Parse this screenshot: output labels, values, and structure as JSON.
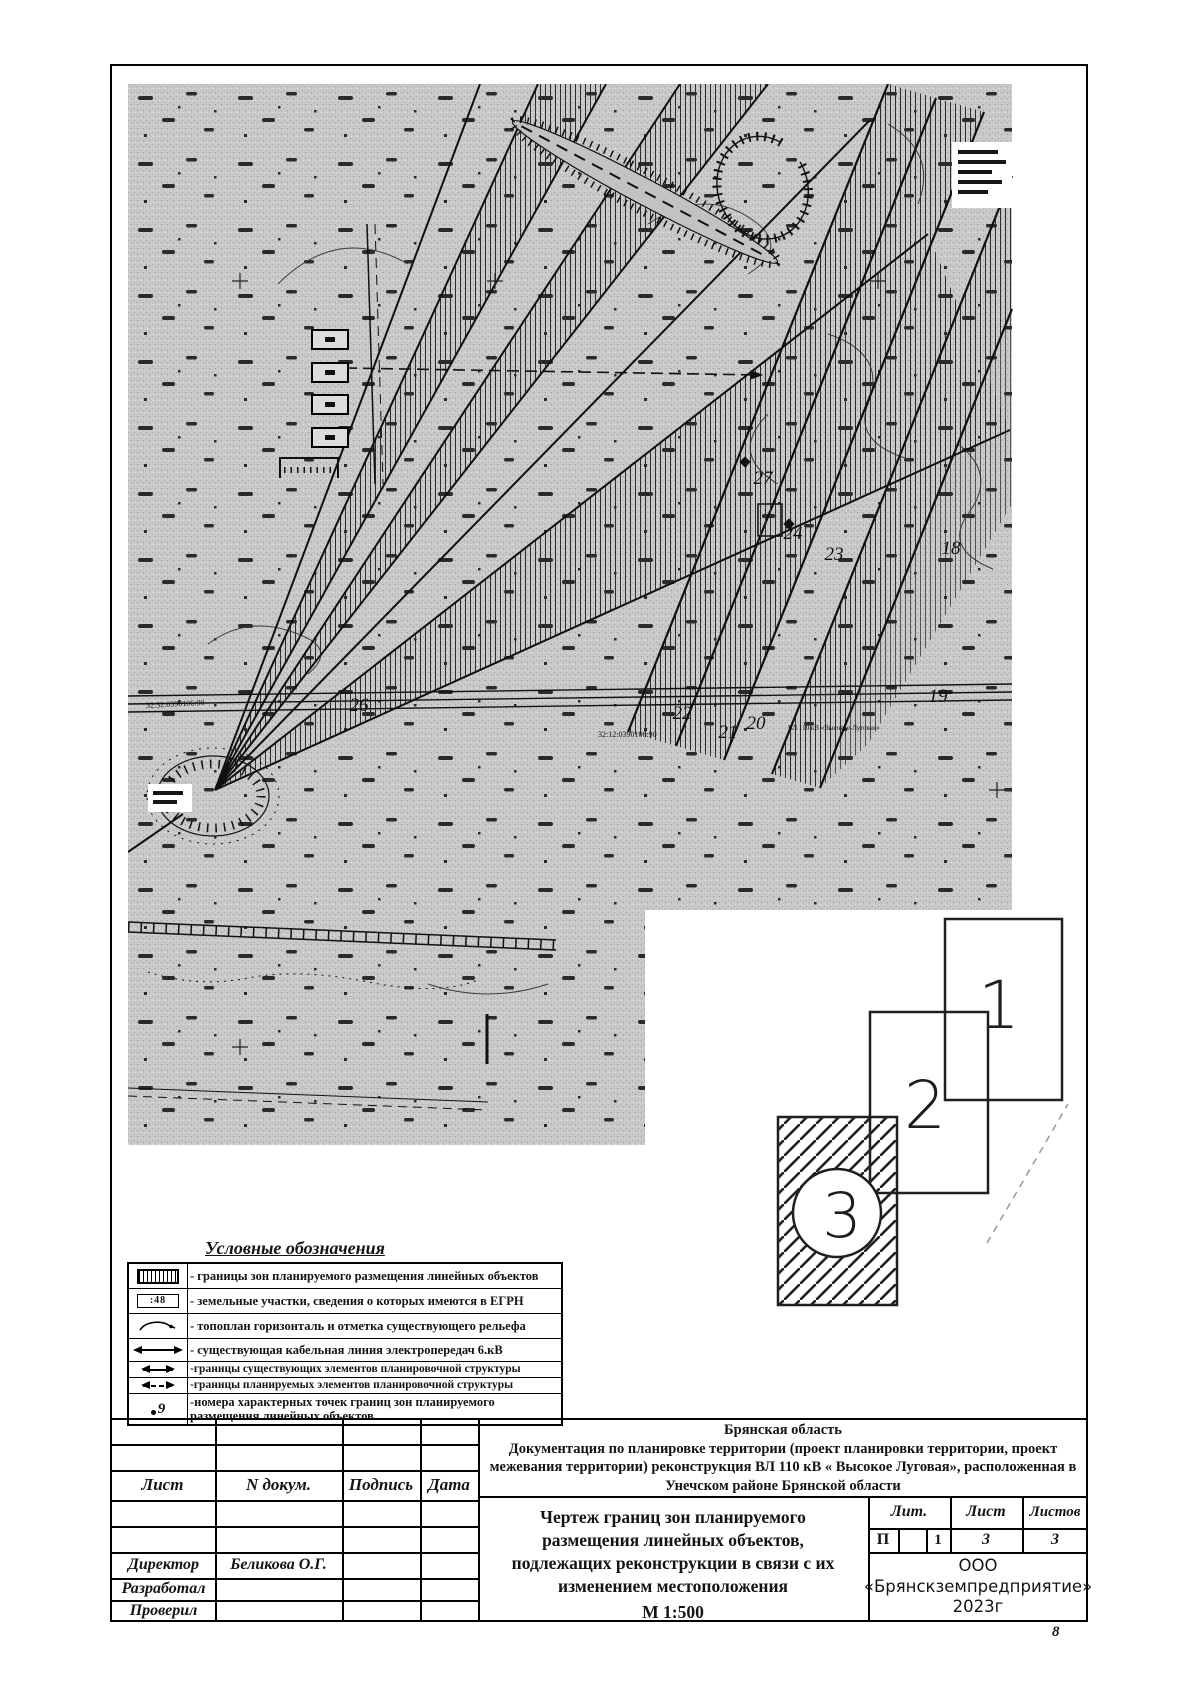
{
  "sheet": {
    "page_number": "8"
  },
  "map": {
    "point_labels": [
      {
        "text": "27"
      },
      {
        "text": "24"
      },
      {
        "text": "23"
      },
      {
        "text": "18"
      },
      {
        "text": "19"
      },
      {
        "text": "26"
      },
      {
        "text": "22"
      },
      {
        "text": "21"
      },
      {
        "text": "20"
      }
    ],
    "cadastral_labels": [
      {
        "text": "32:32:0390106:90"
      },
      {
        "text": "32:12:0390106:90"
      },
      {
        "text": "ВЛ 110 кВ «Высокое-Луговая»"
      }
    ],
    "inset": {
      "labels": [
        "1",
        "2",
        "3"
      ]
    }
  },
  "legend": {
    "title": "Условные обозначения",
    "rows": [
      {
        "symbol": "zone-hatch",
        "text": "- границы зон планируемого размещения линейных объектов"
      },
      {
        "symbol": "parcel-egrn",
        "symbol_text": ":48",
        "text": "- земельные участки, сведения о которых имеются в ЕГРН"
      },
      {
        "symbol": "contour-elevation",
        "text": "- топоплан горизонталь и отметка существующего рельефа"
      },
      {
        "symbol": "cable-line-6kv",
        "text": "- существующая кабельная линия электропередач 6.кВ"
      },
      {
        "symbol": "existing-structure-borders",
        "text": "-границы существующих элементов планировочной структуры"
      },
      {
        "symbol": "planned-structure-borders",
        "text": "-границы планируемых элементов планировочной структуры"
      },
      {
        "symbol": "point-numbers",
        "symbol_text": "9",
        "text": "-номера характерных точек границ зон планируемого размещения линейных объектов"
      }
    ]
  },
  "title_block": {
    "region": "Брянская область",
    "doc_line1": "Документация по планировке территории (проект планировки территории, проект",
    "doc_line2": "межевания территории) реконструкция ВЛ 110 кВ « Высокое Луговая», расположенная в",
    "doc_line3": "Унечском районе Брянской области",
    "columns": {
      "sheet": "Лист",
      "doc_no": "N докум.",
      "signature": "Подпись",
      "date": "Дата"
    },
    "roles": [
      {
        "role": "Директор",
        "name": "Беликова О.Г."
      },
      {
        "role": "Разработал",
        "name": ""
      },
      {
        "role": "Проверил",
        "name": ""
      }
    ],
    "drawing_title_line1": "Чертеж границ зон планируемого",
    "drawing_title_line2": "размещения линейных объектов,",
    "drawing_title_line3": "подлежащих реконструкции в связи с их",
    "drawing_title_line4": "изменением местоположения",
    "scale": "М 1:500",
    "lit_table": {
      "header_lit": "Лит.",
      "header_sheet": "Лист",
      "header_sheets": "Листов",
      "lit_value": "П",
      "lit_sub": "1",
      "sheet_value": "3",
      "sheets_value": "3"
    },
    "org_line1": "ООО",
    "org_line2": "«Брянскземпредприятие»",
    "org_line3": "2023г"
  }
}
